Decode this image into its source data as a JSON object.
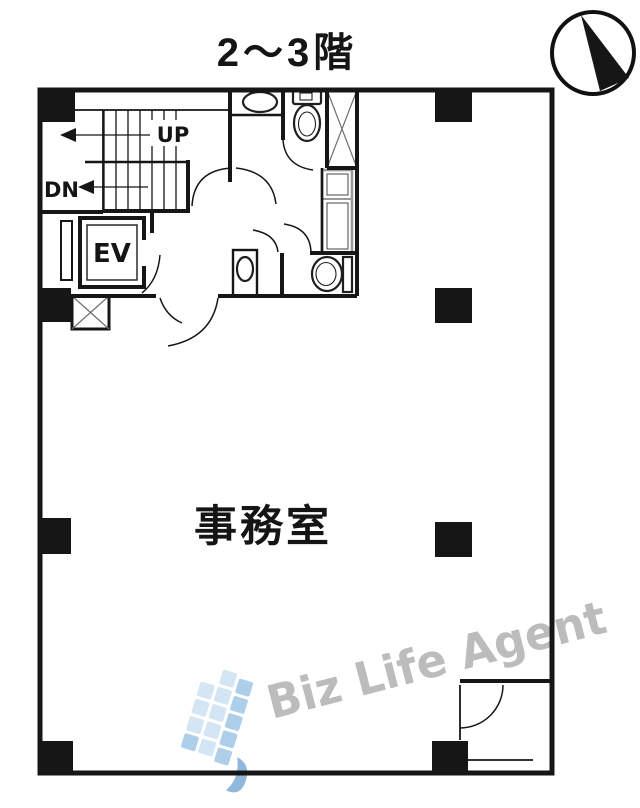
{
  "header": {
    "title": "2～3階"
  },
  "plan": {
    "room_label": "事務室",
    "stairs": {
      "up_label": "UP",
      "down_label": "DN"
    },
    "elevator_label": "EV"
  },
  "watermark": {
    "text": "Biz Life Agent"
  },
  "colors": {
    "wall": "#161616",
    "text": "#151515",
    "shaft_line": "#6f6f6f",
    "fixture_gray": "#9a9a9a",
    "watermark_text": "#b7b7b7",
    "logo_light": "#d4e6f4",
    "logo_mid": "#aecfe9",
    "logo_dark": "#8fb8dc"
  }
}
